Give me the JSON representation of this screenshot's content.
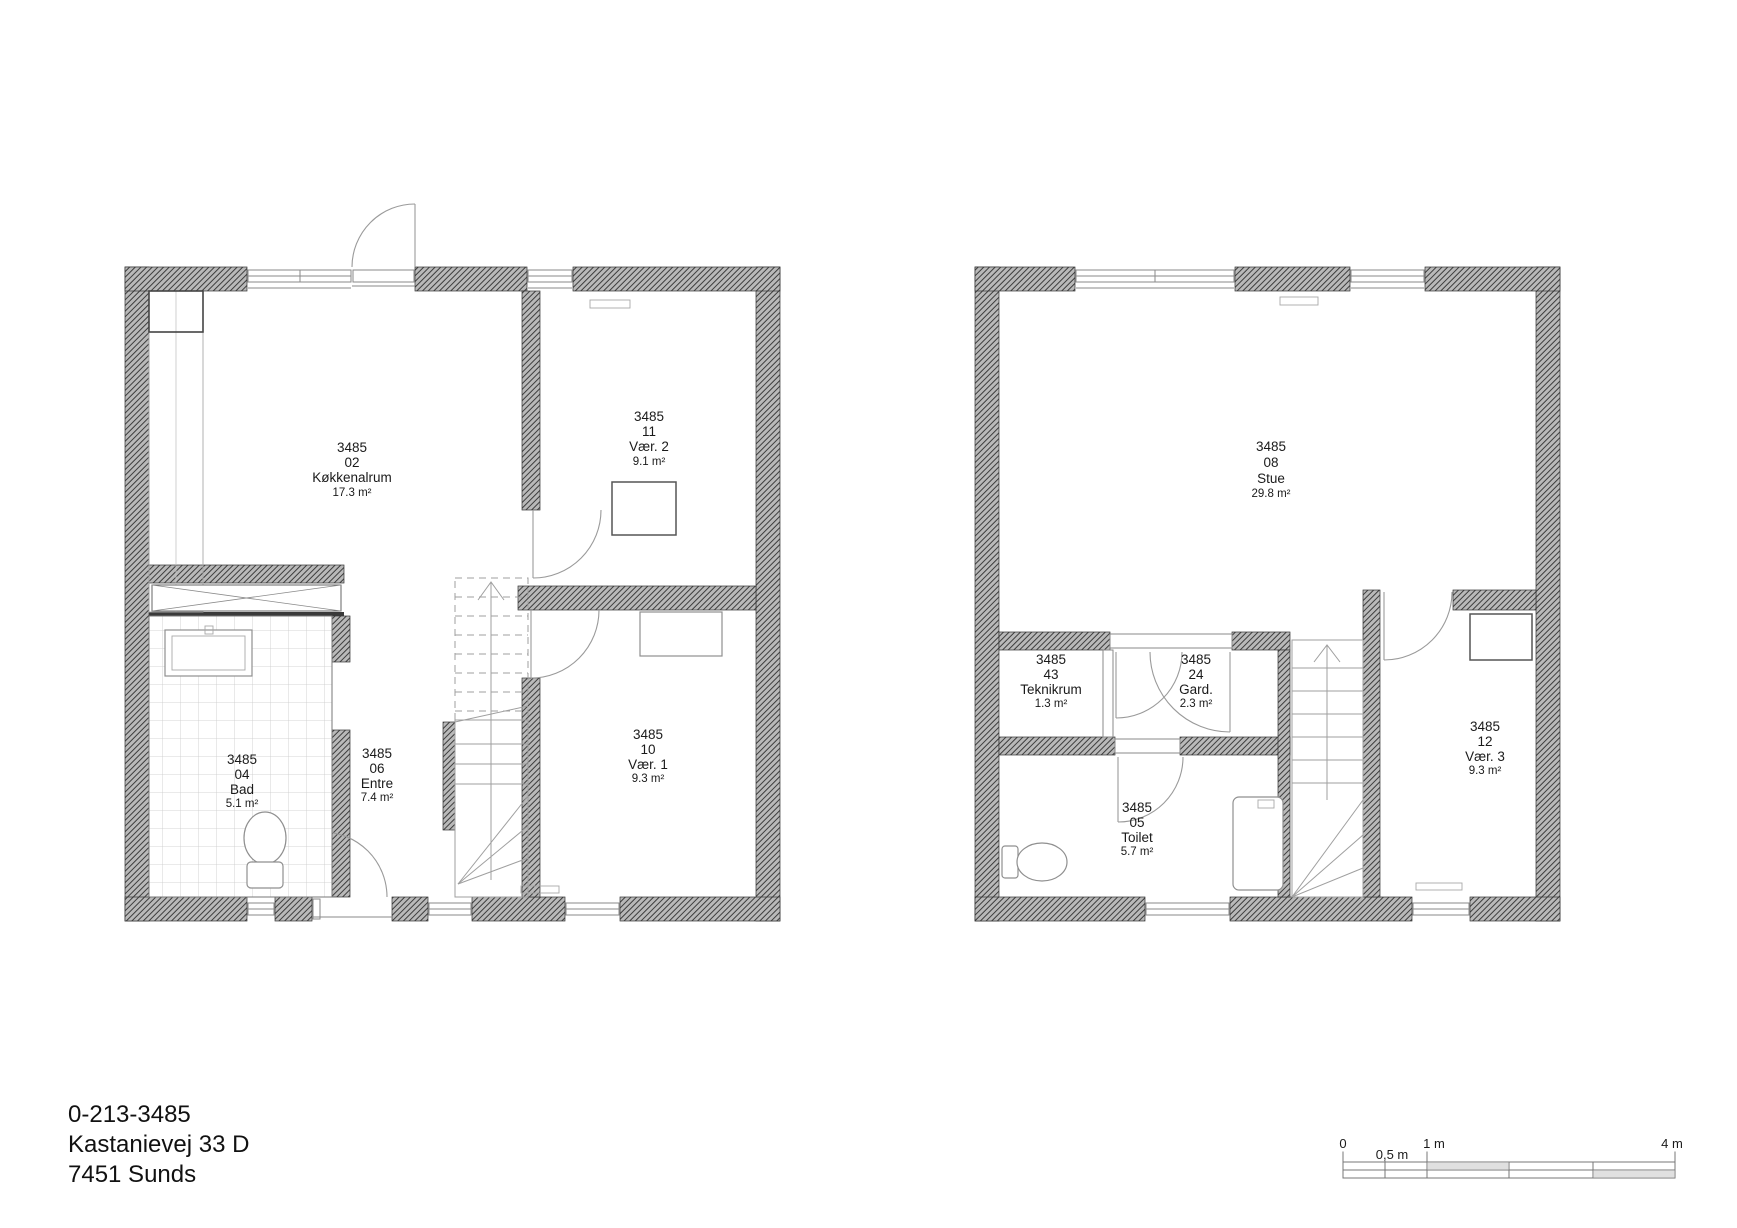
{
  "document": {
    "drawing_number": "0-213-3485",
    "address": "Kastanievej 33 D",
    "postal_city": "7451  Sunds"
  },
  "plans": {
    "ground_floor": {
      "rooms": [
        {
          "project": "3485",
          "number": "02",
          "name": "Køkkenalrum",
          "area": "17.3 m²"
        },
        {
          "project": "3485",
          "number": "11",
          "name": "Vær. 2",
          "area": "9.1 m²"
        },
        {
          "project": "3485",
          "number": "04",
          "name": "Bad",
          "area": "5.1 m²"
        },
        {
          "project": "3485",
          "number": "06",
          "name": "Entre",
          "area": "7.4 m²"
        },
        {
          "project": "3485",
          "number": "10",
          "name": "Vær. 1",
          "area": "9.3 m²"
        }
      ]
    },
    "first_floor": {
      "rooms": [
        {
          "project": "3485",
          "number": "08",
          "name": "Stue",
          "area": "29.8 m²"
        },
        {
          "project": "3485",
          "number": "43",
          "name": "Teknikrum",
          "area": "1.3 m²"
        },
        {
          "project": "3485",
          "number": "24",
          "name": "Gard.",
          "area": "2.3 m²"
        },
        {
          "project": "3485",
          "number": "05",
          "name": "Toilet",
          "area": "5.7 m²"
        },
        {
          "project": "3485",
          "number": "12",
          "name": "Vær. 3",
          "area": "9.3 m²"
        }
      ]
    }
  },
  "scale_bar": {
    "labels": {
      "zero": "0",
      "half": "0,5 m",
      "one": "1 m",
      "four": "4 m"
    }
  },
  "colors": {
    "wall_hatch_dark": "#3d3d3d",
    "wall_hatch_light": "#b9b9b9",
    "line_gray": "#9a9a9a"
  }
}
